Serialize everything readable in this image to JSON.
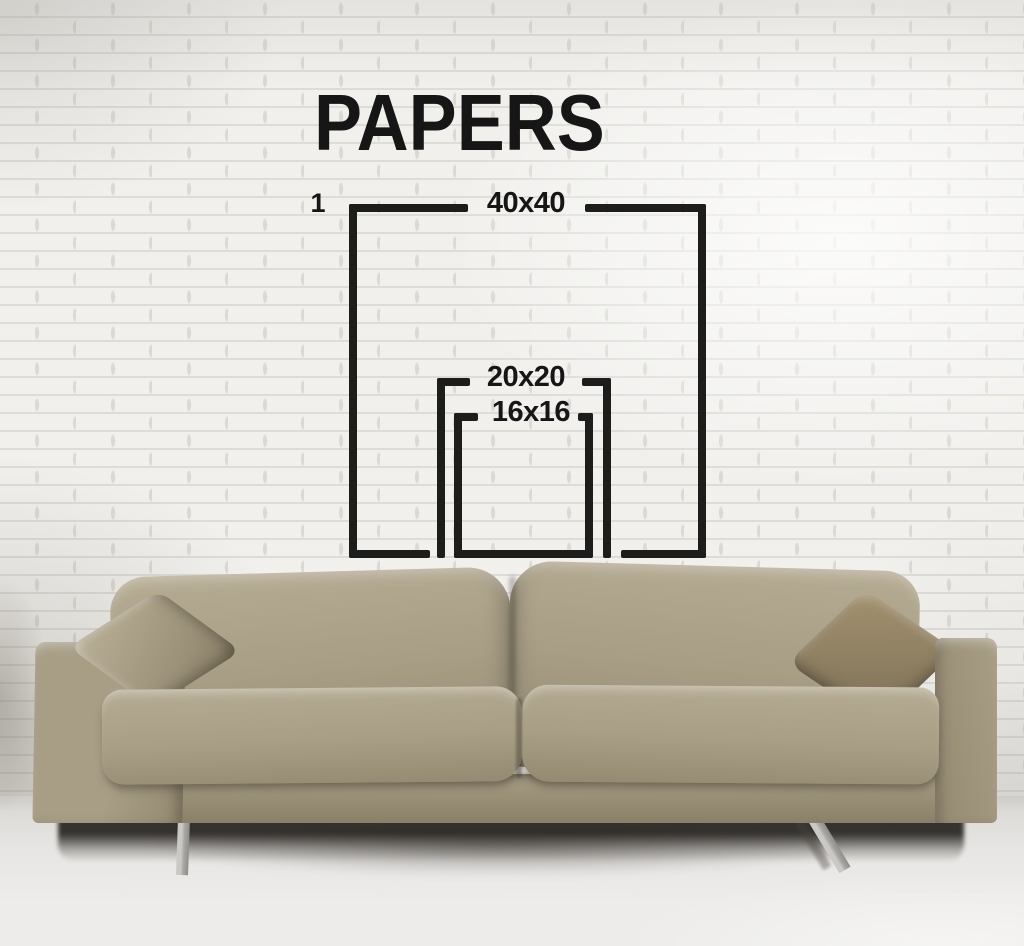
{
  "title": "PAPERS",
  "diagram": {
    "index_label": "1",
    "line_color": "#1d1d1b",
    "text_color": "#161616",
    "sizes": [
      {
        "label": "40x40",
        "width": 40,
        "height": 40
      },
      {
        "label": "20x20",
        "width": 20,
        "height": 20
      },
      {
        "label": "16x16",
        "width": 16,
        "height": 16
      }
    ]
  },
  "scene": {
    "colors": {
      "wall": "#f1f0ed",
      "wall_mortar": "#c9c5bd",
      "floor": "#edecea",
      "sofa_light": "#b5ab93",
      "sofa": "#a89e86",
      "sofa_dark": "#948a72",
      "base_dark": "#8a8068",
      "pillow_left": "#9a9078",
      "pillow_right": "#8e7f62",
      "leg": "#cbc9c5",
      "leg_dark": "#8f8d89",
      "shadow": "#2e2b26"
    }
  }
}
